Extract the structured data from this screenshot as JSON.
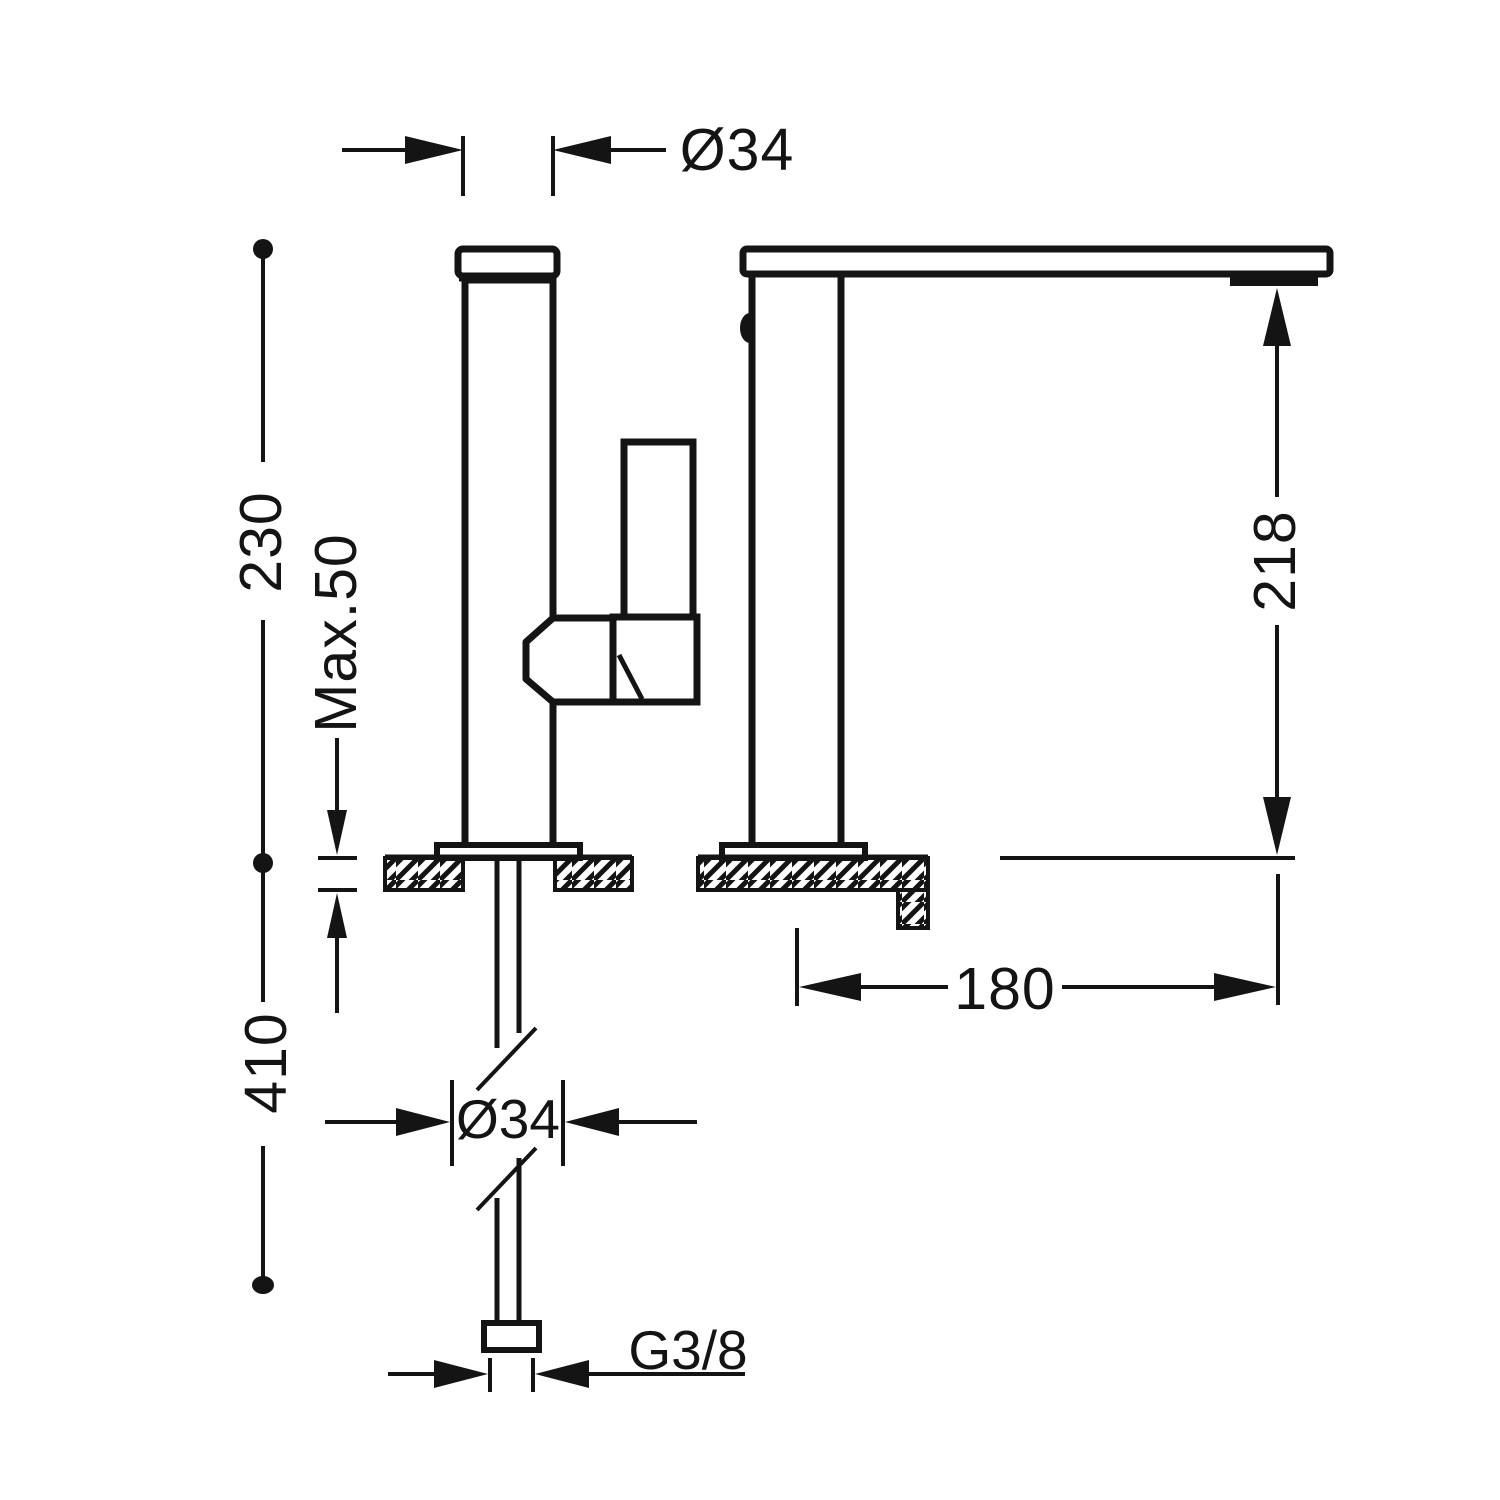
{
  "drawing": {
    "background": "#ffffff",
    "line_color": "#141414",
    "labels": {
      "top_diameter": "Ø34",
      "height_above_deck": "230",
      "max_deck_thickness": "Max.50",
      "length_below_deck": "410",
      "spout_clearance": "218",
      "spout_reach": "180",
      "base_diameter": "Ø34",
      "supply_connection": "G3/8"
    }
  }
}
